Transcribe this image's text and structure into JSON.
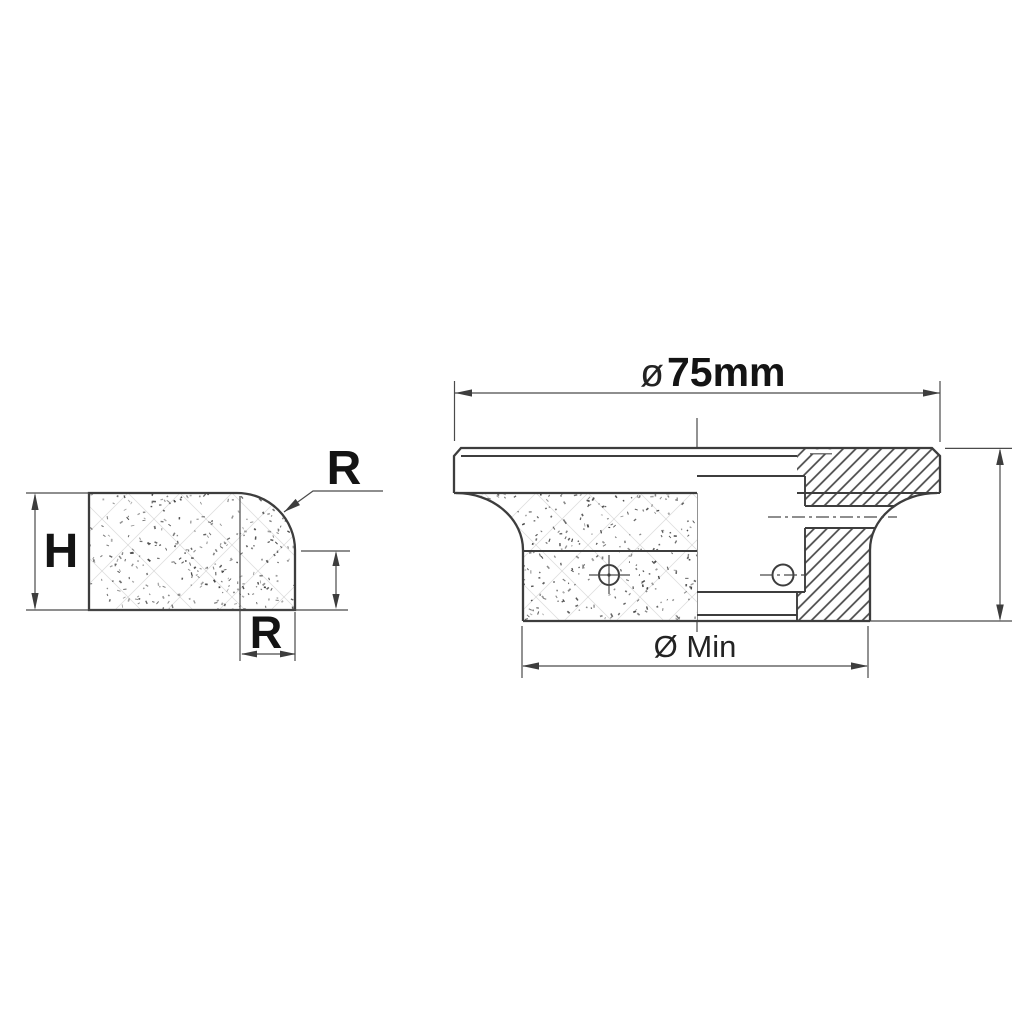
{
  "drawing": {
    "title_context": "profile wheel technical drawing",
    "profile_view": {
      "height_label": "H",
      "radius_label_top": "R",
      "radius_label_bottom": "R"
    },
    "section_view": {
      "diameter_symbol": "ø",
      "diameter_value": "75mm",
      "min_diameter_label": "Ø Min"
    },
    "colors": {
      "line": "#3d3d3d",
      "text": "#141414",
      "background": "#ffffff"
    }
  }
}
